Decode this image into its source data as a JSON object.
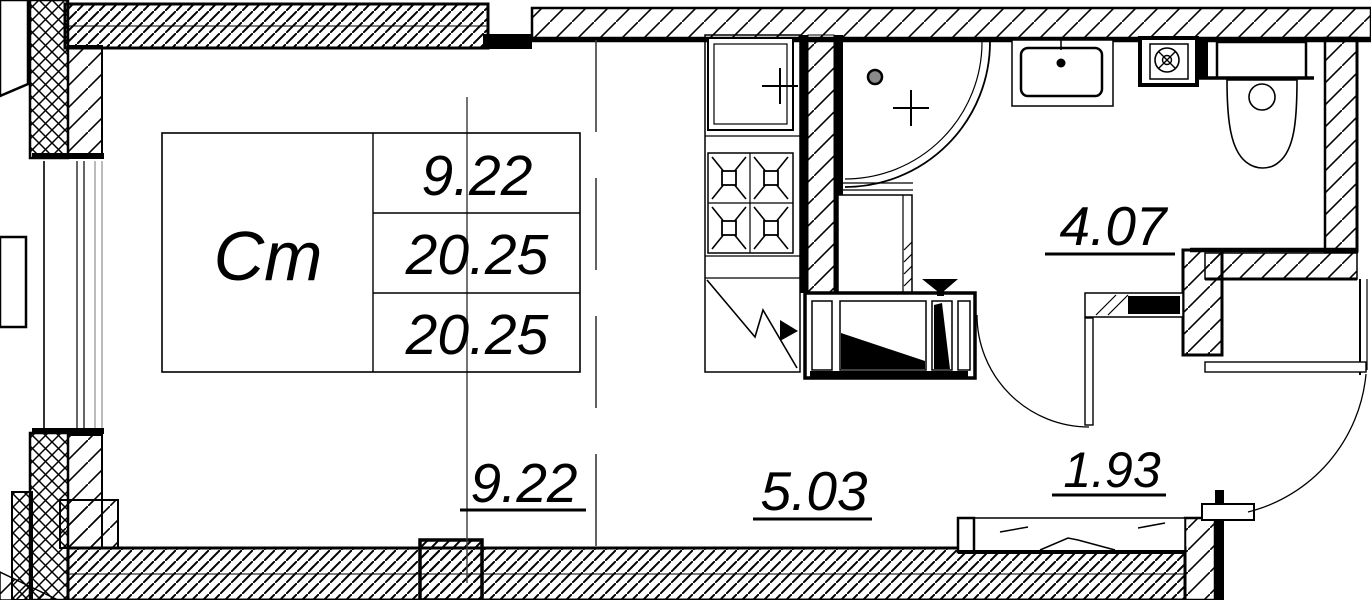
{
  "title": "Studio apartment floor plan",
  "stamp": {
    "type_label": "Ст",
    "values": [
      "9.22",
      "20.25",
      "20.25"
    ]
  },
  "rooms": {
    "living_area": "9.22",
    "kitchen_area": "5.03",
    "bathroom_area": "4.07",
    "hall_area": "1.93"
  },
  "colors": {
    "line": "#000000",
    "bg": "#ffffff",
    "thin_line": "#3a3a3a"
  }
}
